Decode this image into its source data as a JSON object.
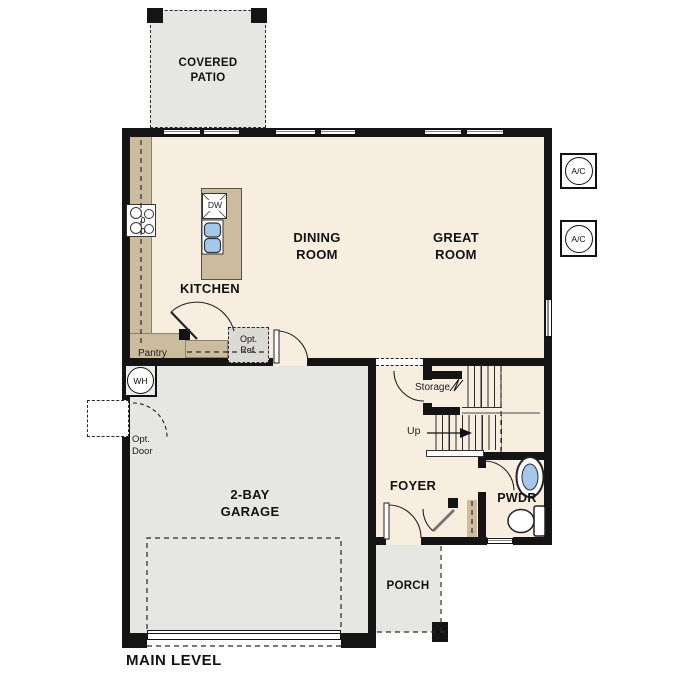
{
  "plan_title": "MAIN LEVEL",
  "rooms": {
    "covered_patio": "COVERED PATIO",
    "kitchen": "KITCHEN",
    "dining_room": "DINING ROOM",
    "great_room": "GREAT ROOM",
    "garage": "2-BAY GARAGE",
    "foyer": "FOYER",
    "powder_room": "PWDR",
    "porch": "PORCH"
  },
  "annotations": {
    "pantry": "Pantry",
    "storage": "Storage",
    "stairs_direction": "Up",
    "optional_refrigerator_line1": "Opt.",
    "optional_refrigerator_line2": "Ref.",
    "optional_door_line1": "Opt.",
    "optional_door_line2": "Door"
  },
  "equipment": {
    "dishwasher": "DW",
    "water_heater": "WH",
    "ac_unit_1": "A/C",
    "ac_unit_2": "A/C"
  },
  "colors": {
    "floor_cream": "#F7EEE0",
    "counter_tan": "#CBBC9E",
    "concrete_gray": "#E6E6E2",
    "fixture_blue": "#A5C7E9",
    "wall_black": "#141414"
  }
}
